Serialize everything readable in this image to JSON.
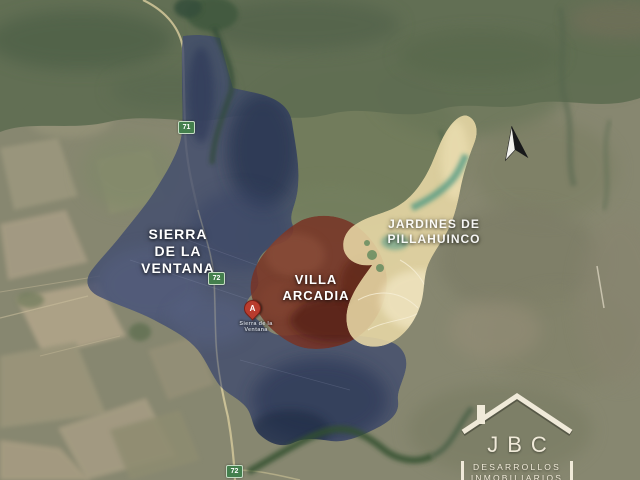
{
  "map": {
    "description": "Satellite promotional map of towns near Sierra de la Ventana",
    "regions": {
      "sierra": {
        "name": "Sierra de la Ventana",
        "lines": [
          "SIERRA",
          "DE LA",
          "VENTANA"
        ],
        "fill": "#3e4b71"
      },
      "villa": {
        "name": "Villa Arcadia",
        "lines": [
          "VILLA",
          "ARCADIA"
        ],
        "fill": "#7c3122"
      },
      "jardines": {
        "name": "Jardines de Pillahuinco",
        "lines": [
          "JARDINES DE",
          "PILLAHUINCO"
        ],
        "fill": "#e9d8a2"
      }
    }
  },
  "route_shields": [
    {
      "number": "71"
    },
    {
      "number": "72"
    },
    {
      "number": "72"
    }
  ],
  "marker": {
    "letter": "A",
    "caption_line1": "Sierra de la",
    "caption_line2": "Ventana"
  },
  "logo": {
    "brand": "JBC",
    "subtitle_line1": "DESARROLLOS",
    "subtitle_line2": "INMOBILIARIOS"
  },
  "icons": {
    "north_arrow": "black-and-white north needle",
    "map_pin": "red teardrop pin with letter",
    "house_roof": "real-estate roof outline with chimney"
  },
  "colors": {
    "region_blue": "#3e4b71",
    "region_red": "#7c3122",
    "region_yellow": "#e9d8a2",
    "shield_green": "#41804a",
    "label_text": "#ffffff",
    "logo_cream": "#f0ead8",
    "road_tan": "#cfc393"
  }
}
